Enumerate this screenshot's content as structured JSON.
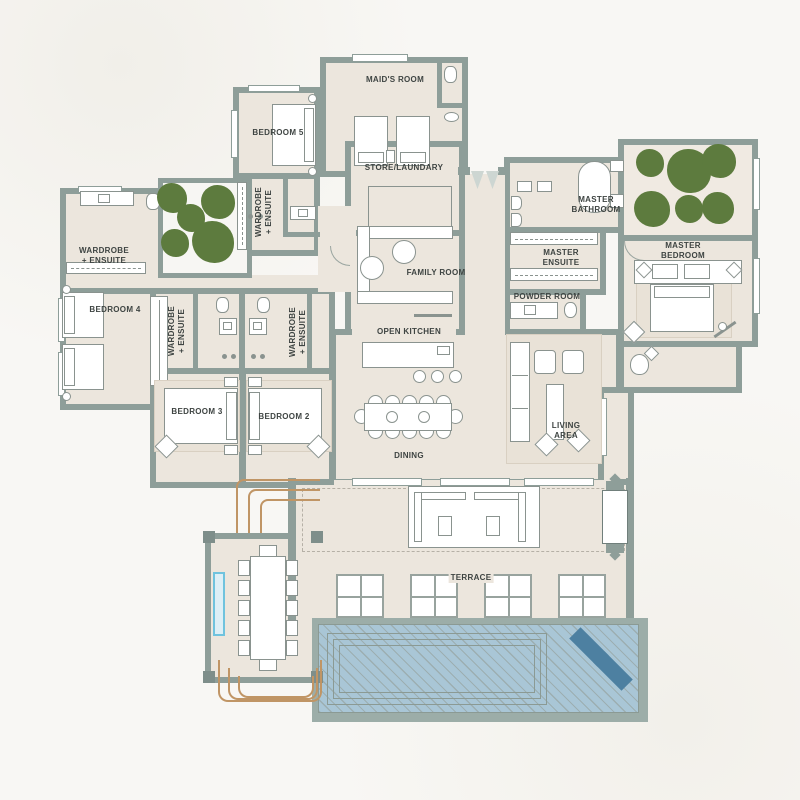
{
  "meta": {
    "type": "architectural-floor-plan",
    "description": "Single-storey villa floor plan with pool, terrace and courtyards"
  },
  "palette": {
    "wall": "#8E9E99",
    "floor": "#ECE6DD",
    "courtyard_floor": "#F0EAE2",
    "paper": "#F8F7F4",
    "tree_green": "#5D7B3E",
    "pool_water": "#A9C6D6",
    "pool_lounger": "#4D80A1",
    "landscape_tan": "#C09565",
    "window_accent": "#6FC3DE",
    "label_text": "#3E4442"
  },
  "labels": {
    "maids_room": "MAID'S ROOM",
    "bedroom5": "BEDROOM 5",
    "bedroom4": "BEDROOM 4",
    "bedroom3": "BEDROOM 3",
    "bedroom2": "BEDROOM 2",
    "wardrobe_ensuite": "WARDROBE\n+ ENSUITE",
    "store_laundry": "STORE/LAUNDARY",
    "family_room": "FAMILY ROOM",
    "master_bathroom": "MASTER\nBATHROOM",
    "master_ensuite": "MASTER\nENSUITE",
    "master_bedroom": "MASTER\nBEDROOM",
    "powder_room": "POWDER ROOM",
    "open_kitchen": "OPEN KITCHEN",
    "dining": "DINING",
    "living_area": "LIVING\nAREA",
    "terrace": "TERRACE"
  }
}
